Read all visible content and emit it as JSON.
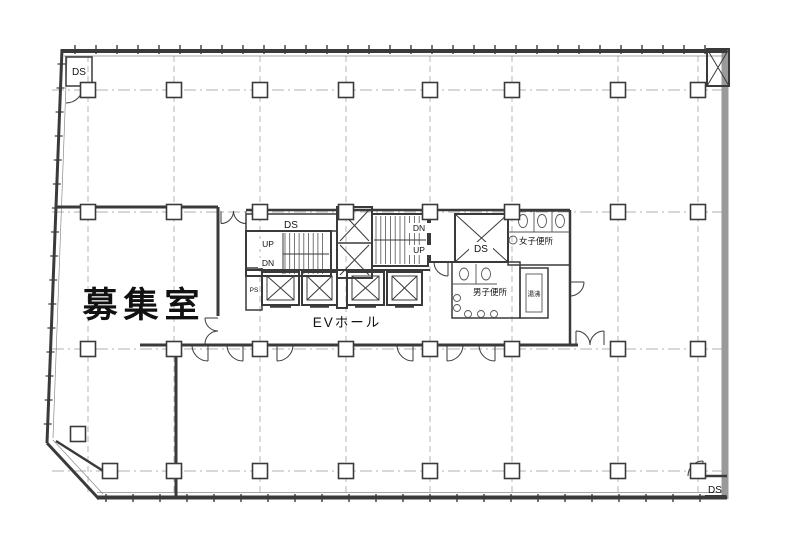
{
  "colors": {
    "line": "#3a3a3a",
    "grid_line": "#b0b0b0",
    "wall_gray": "#9a9a9a",
    "background": "#ffffff",
    "text": "#111111"
  },
  "labels": {
    "vacant_room": "募集室",
    "ev_hall": "EVホール",
    "womens_toilet": "女子便所",
    "mens_toilet": "男子便所",
    "kitchenette": "湯沸",
    "duct_top_left": "DS",
    "duct_core_left": "DS",
    "duct_core_right": "DS",
    "duct_bottom_right": "DS",
    "pipe_space": "PS",
    "stair_west_up": "UP",
    "stair_west_down": "DN",
    "stair_east_up": "UP",
    "stair_east_down": "DN"
  }
}
